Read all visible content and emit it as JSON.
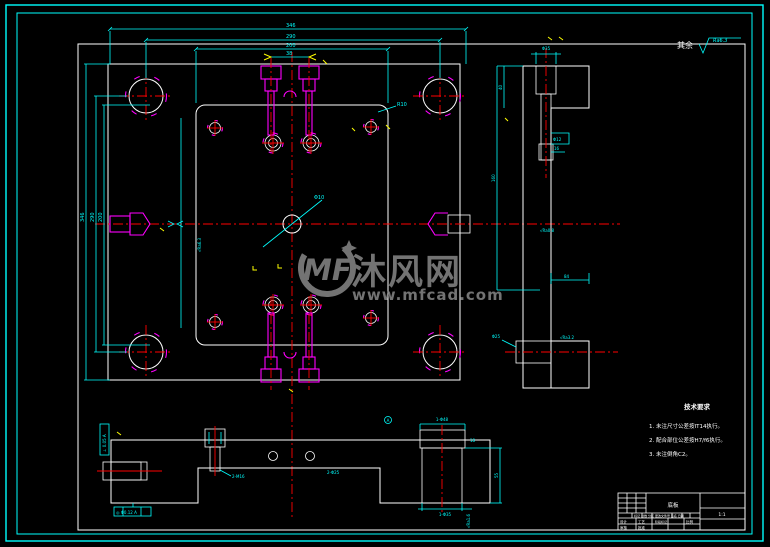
{
  "watermark": {
    "logo_text": "MF",
    "site_name": "沐风网",
    "site_url": "www.mfcad.com",
    "color": "#8d8d8d"
  },
  "surface_note": {
    "prefix": "其余",
    "roughness": "Ra6.3"
  },
  "tech_notes": {
    "title": "技术要求",
    "item1": "1. 未注尺寸公差按IT14执行。",
    "item2": "2. 配合部位公差按H7/f6执行。",
    "item3": "3. 未注倒角C2。"
  },
  "dims": {
    "top1": "346",
    "top2": "290",
    "top3": "200",
    "top4": "38",
    "left1": "346",
    "left2": "290",
    "left3": "200",
    "center_hole": "Φ10",
    "corner_radius": "R10",
    "plate_ra": "√Ra6.3",
    "rv_top": "Φ35",
    "rv_h1": "40",
    "rv_h2": "160",
    "rv_d1": "Φ12",
    "rv_d2": "16",
    "rv_w": "84",
    "rv_hole": "Φ25",
    "rv_ra1": "√Ra0.8",
    "rv_ra2": "√Ra3.2",
    "bb_screw": "2-M16",
    "bb_holes": "2-Φ25",
    "bb_tol_left": "⊥ 0.05 A",
    "bb_tol_bottom": "◎ Φ0.12 A",
    "pin_top": "1-Φ48",
    "pin_bottom": "1-Φ35",
    "pin_h": "55",
    "pin_t": "18",
    "pin_ra": "√Ra1.6",
    "pin_datum": "A"
  },
  "title_block": {
    "part_name": "底板",
    "row_labels": "标记 处数 分区 更改文件号 签名 日期",
    "designer": "设计",
    "checker": "审核",
    "process": "工艺",
    "approver": "批准",
    "stage": "阶段标记",
    "scale_label": "比例",
    "scale": "1:1"
  },
  "colors": {
    "line_cyan": "#00ffff",
    "line_white": "#ffffff",
    "line_red": "#ff0000",
    "line_magenta": "#ff00ff",
    "hatch_yellow": "#ffff00",
    "watermark_gray": "#8d8d8d"
  }
}
